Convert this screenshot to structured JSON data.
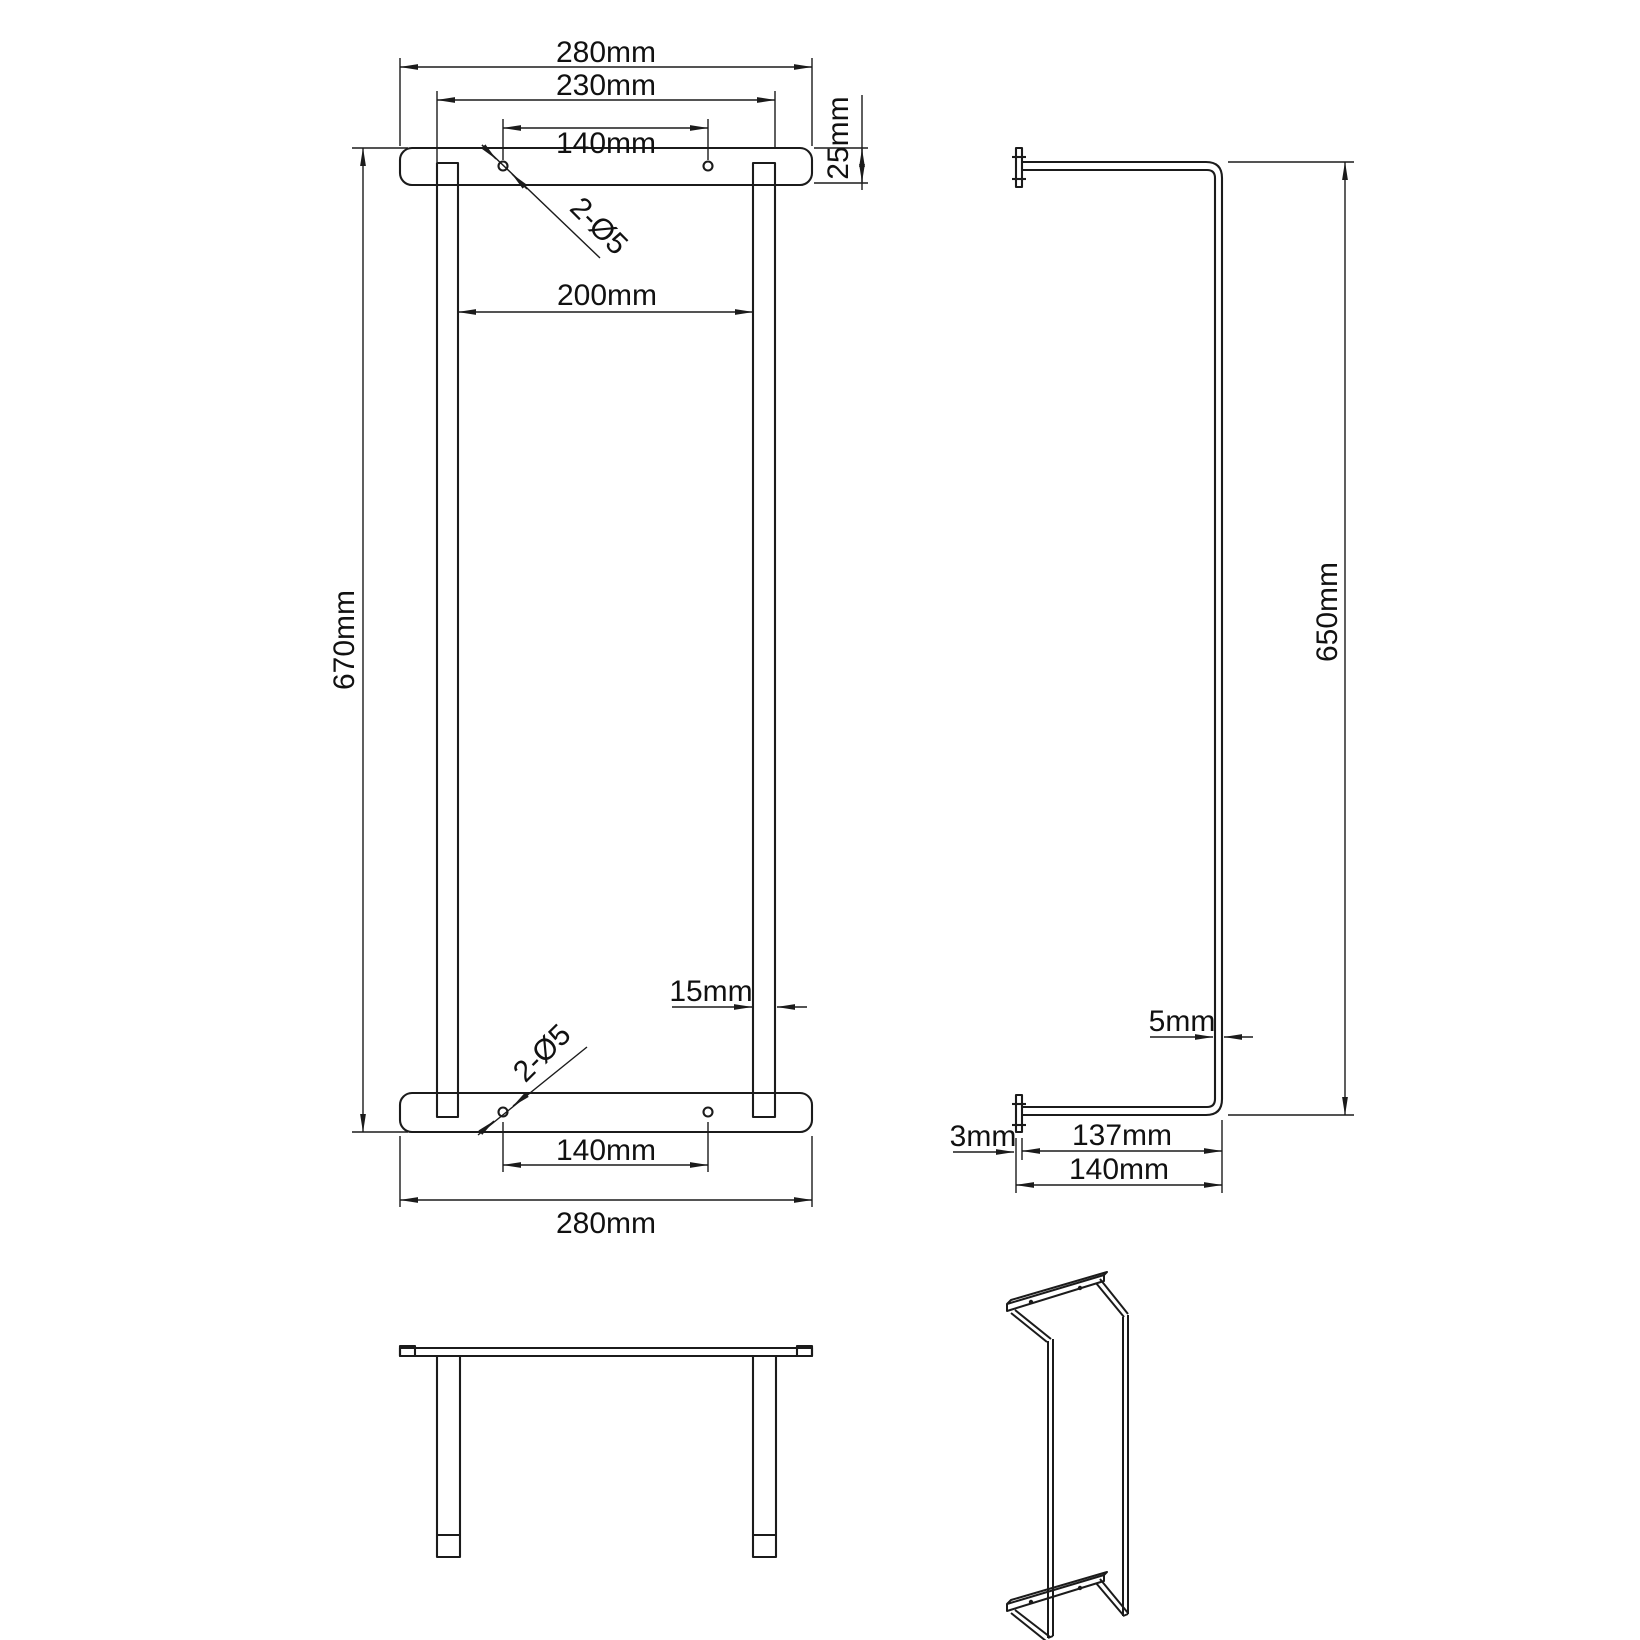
{
  "colors": {
    "line": "#1b1b1b",
    "background": "#ffffff"
  },
  "front_view": {
    "width_top": "280mm",
    "plate_width": "230mm",
    "hole_spacing_top": "140mm",
    "bar_height": "25mm",
    "hole_callout_top": "2-Ø5",
    "inner_width": "200mm",
    "total_height": "670mm",
    "post_width": "15mm",
    "hole_callout_bottom": "2-Ø5",
    "hole_spacing_bottom": "140mm",
    "width_bottom": "280mm"
  },
  "side_view": {
    "total_height": "650mm",
    "tube_thickness": "5mm",
    "plate_thickness": "3mm",
    "depth_inner": "137mm",
    "depth_total": "140mm"
  }
}
